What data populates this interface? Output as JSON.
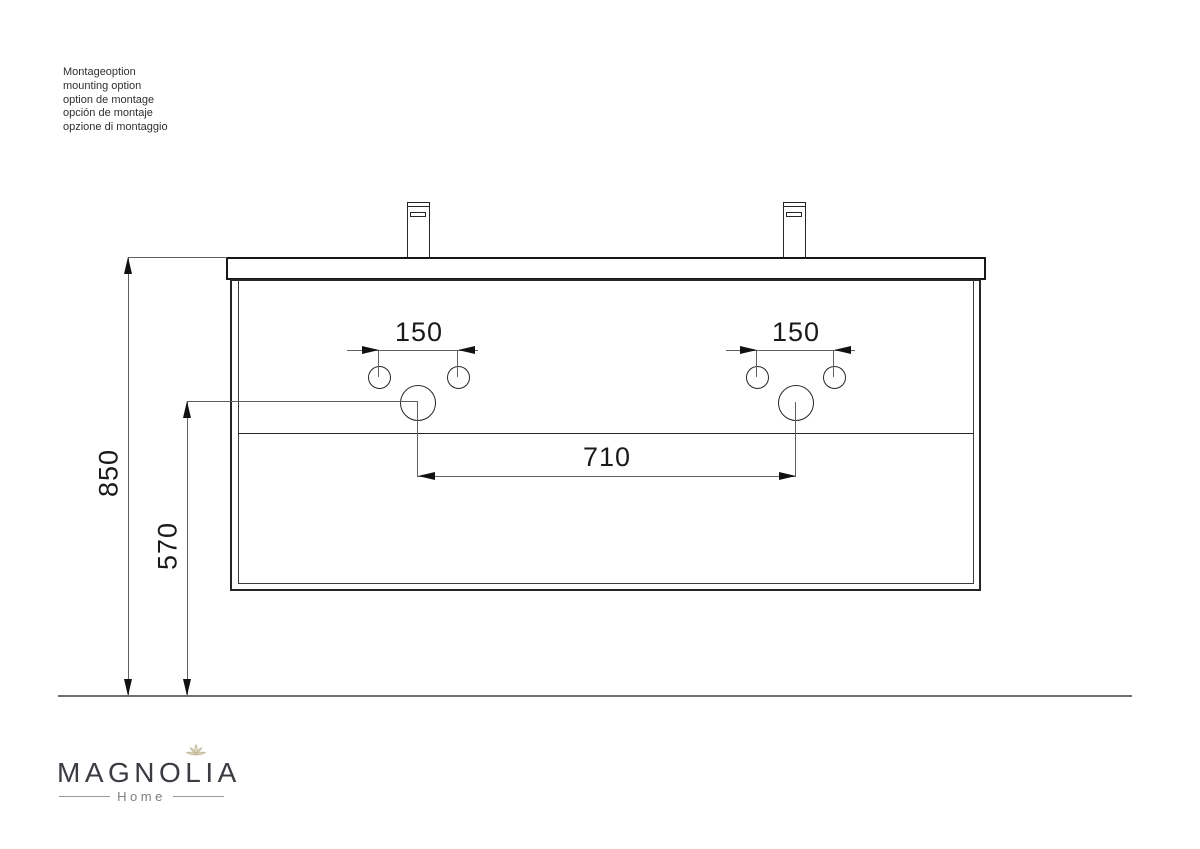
{
  "notes": {
    "lines": [
      "Montageoption",
      "mounting option",
      "option de montage",
      "opción de montaje",
      "opzione di montaggio"
    ]
  },
  "dimensions": {
    "total_height": "850",
    "drain_height": "570",
    "faucet_hole_spacing_left": "150",
    "faucet_hole_spacing_right": "150",
    "drain_spacing": "710"
  },
  "logo": {
    "brand": "MAGNOLIA",
    "sub": "Home",
    "flower_icon": "magnolia-flower"
  },
  "colors": {
    "outline": "#262626",
    "dimension_line": "#5f5f5f",
    "arrow": "#111111",
    "floor_line": "#6f6f6f",
    "brand_text": "#3b3b42",
    "sub_text": "#7f7f7f",
    "flower": "#c4ba99"
  }
}
